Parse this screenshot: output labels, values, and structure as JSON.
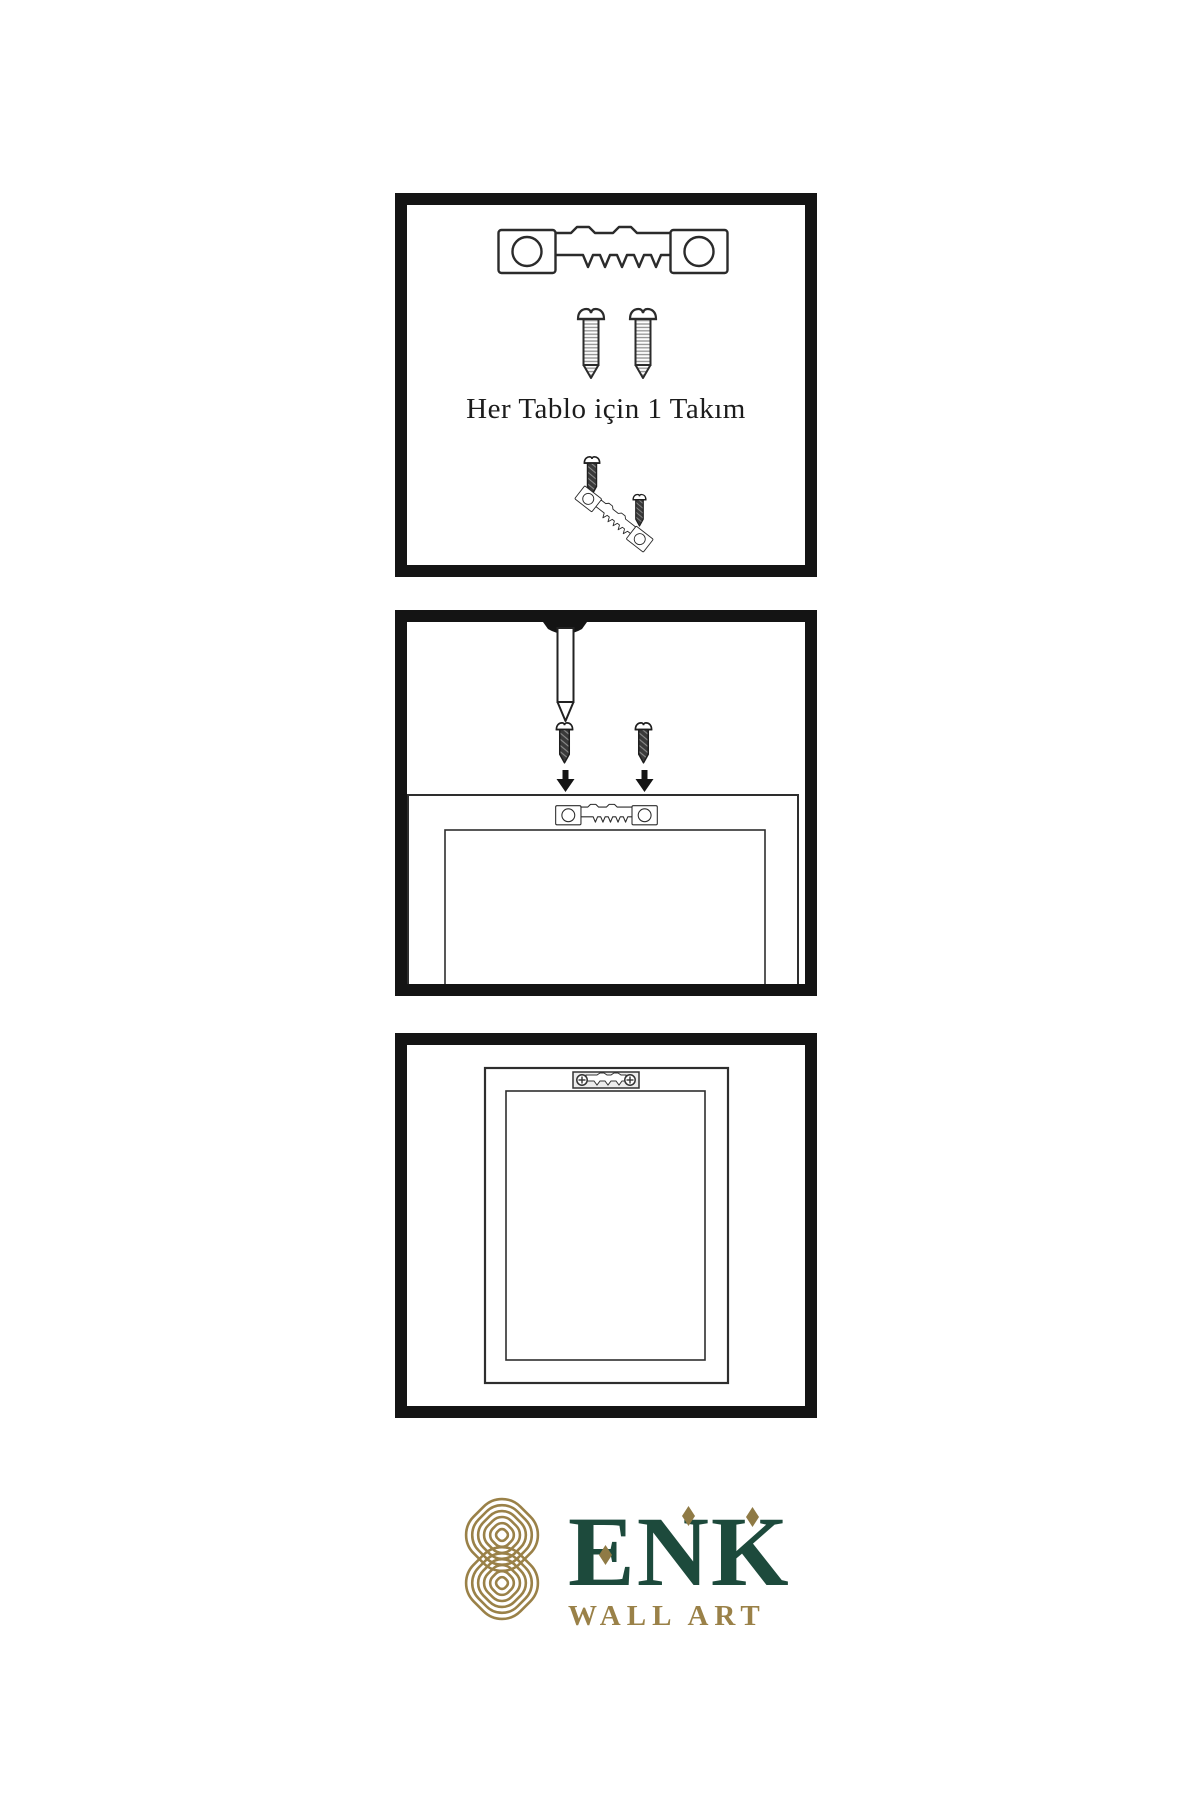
{
  "page": {
    "background": "#ffffff"
  },
  "instructions": {
    "step1": {
      "caption": "Her Tablo için 1 Takım",
      "icons": [
        "sawtooth-hanger-icon",
        "screw-icon",
        "screw-icon",
        "screw-into-hanger-icon"
      ]
    },
    "step2": {
      "icons": [
        "wall-nail-icon",
        "screw-icon",
        "screw-icon",
        "arrow-down-icon",
        "arrow-down-icon",
        "frame-back-icon",
        "sawtooth-hanger-icon"
      ]
    },
    "step3": {
      "icons": [
        "hanging-frame-icon",
        "sawtooth-hanger-icon"
      ]
    }
  },
  "brand": {
    "logo_icon": "knot-icon",
    "name": "ENK",
    "subtitle": "WALL ART",
    "colors": {
      "brand_green": "#1d4a3c",
      "brand_gold": "#9a8148",
      "line_black": "#1a1a1a"
    }
  }
}
